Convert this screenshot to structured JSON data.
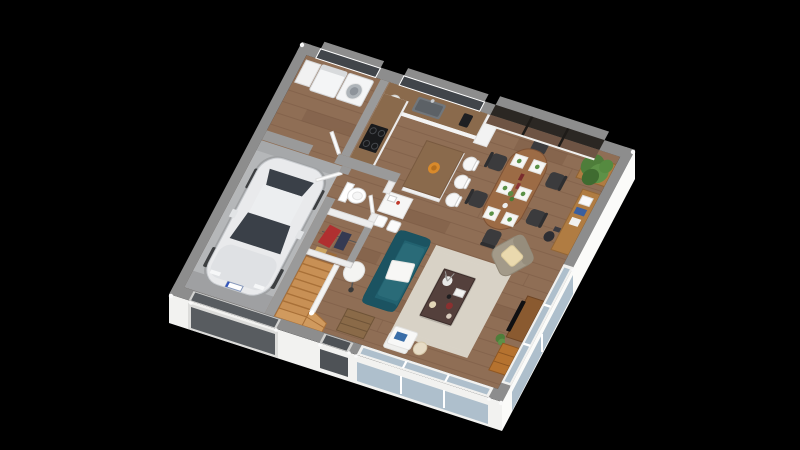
{
  "scene": {
    "description": "3D isometric render of a house ground-floor plan on a black background",
    "rooms": [
      "garage",
      "laundry-room",
      "kitchen",
      "dining-area",
      "living-room",
      "hallway",
      "wc",
      "closet",
      "staircase"
    ],
    "objects": [
      "white-hatchback-car",
      "washing-machine",
      "dryer",
      "kitchen-counter",
      "cooktop",
      "sink",
      "kitchen-island",
      "bar-stools",
      "dining-table",
      "dining-chairs",
      "place-settings",
      "potted-plant",
      "sideboard-desk",
      "teal-sofa",
      "white-blanket",
      "area-rug",
      "coffee-table",
      "armchair",
      "cream-pillow",
      "tv-cabinet",
      "oak-lowboard",
      "console-bench",
      "floor-lamp",
      "side-table",
      "toilet",
      "wardrobe-clothes",
      "wood-stairs",
      "sliding-glass-doors",
      "front-door",
      "garage-door",
      "windows"
    ]
  },
  "colors": {
    "background": "#000000",
    "wall_top": "#8d8d8d",
    "wall_top_inner": "#9a9a9a",
    "partition_white": "#ededed",
    "wall_face": "#f2f2f0",
    "wood_floor": "#8f6e55",
    "plank_line": "#7a5a45",
    "garage_floor": "#b5b7b9",
    "car_body": "#e9eaec",
    "car_glass": "#3a4048",
    "sofa": "#226270",
    "sofa_cushion": "#2a6b78",
    "rug": "#ebe7de",
    "rug_line": "#d8d2c6",
    "coffee_table": "#54403c",
    "armchair": "#a39a89",
    "pillow": "#ead9ae",
    "dining_table": "#9c6b45",
    "chair_dark": "#3b3b3d",
    "counter_wood": "#8a6a4c",
    "cabinet_white": "#ebebeb",
    "stairs": "#c89055",
    "tv_unit": "#8a5a30",
    "oak_cabinet": "#b5722f",
    "desk_wood": "#b07c42",
    "glass": "#aebfcc",
    "window_dark": "#41454a",
    "door_dark": "#4e5256",
    "garage_door": "#585c60",
    "plant_green": "#4e7d3a",
    "accent_red": "#b03030",
    "blanket": "#f7f7f5"
  }
}
